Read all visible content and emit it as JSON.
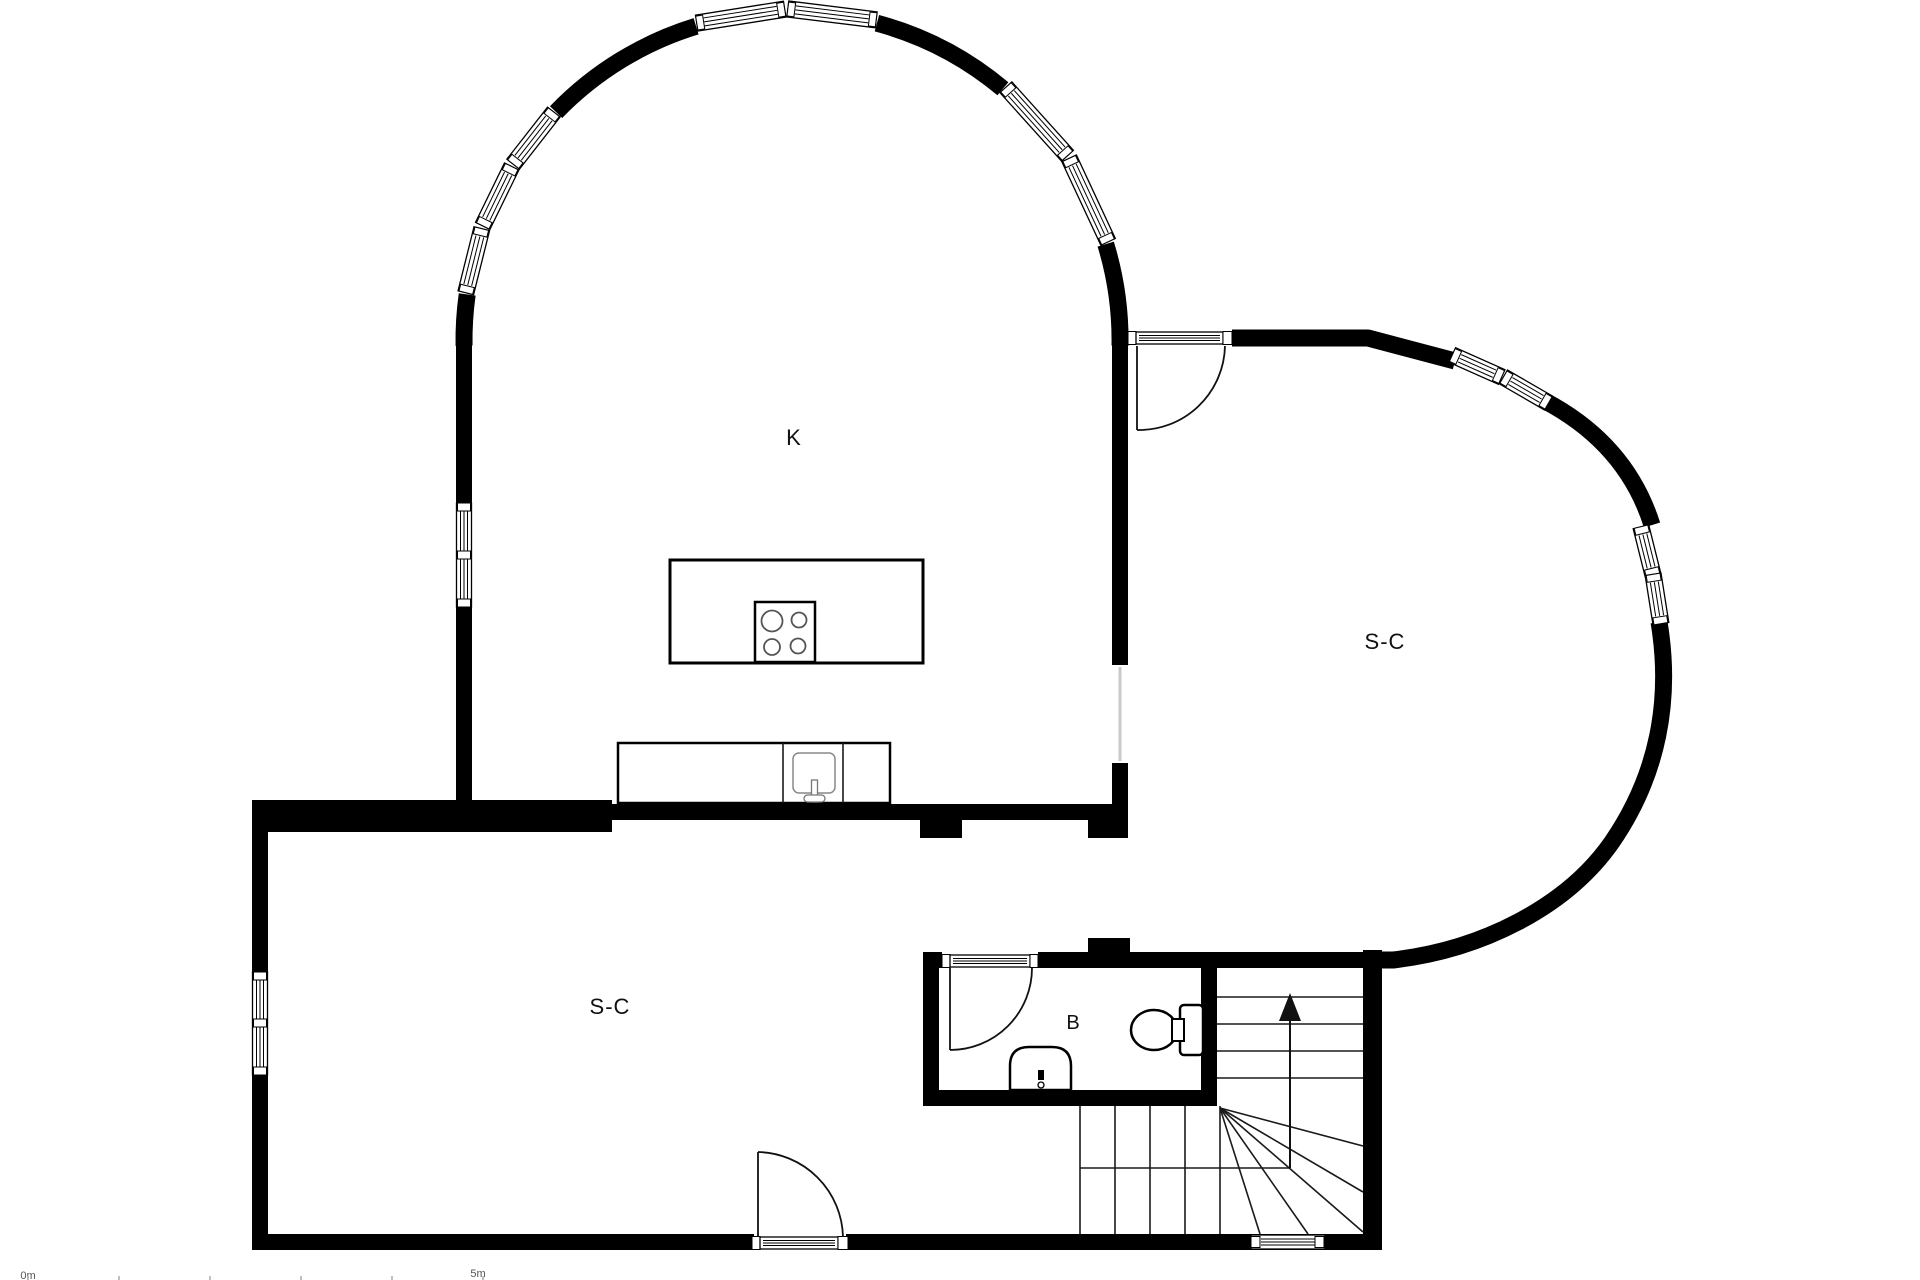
{
  "title": "Floor plan",
  "colors": {
    "background": "#ffffff",
    "walls": "#000000",
    "labels": "#111111",
    "thin_lines": "#1a1a1a",
    "burner_stroke": "#555555",
    "passage_line": "#c9c9c9",
    "scale_text": "#555555"
  },
  "rooms": {
    "kitchen": {
      "label": "K"
    },
    "suite_right": {
      "label": "S-C"
    },
    "suite_lower": {
      "label": "S-C"
    },
    "bathroom": {
      "label": "B"
    }
  },
  "scale_bar": {
    "start": "0m",
    "end": "5m"
  }
}
